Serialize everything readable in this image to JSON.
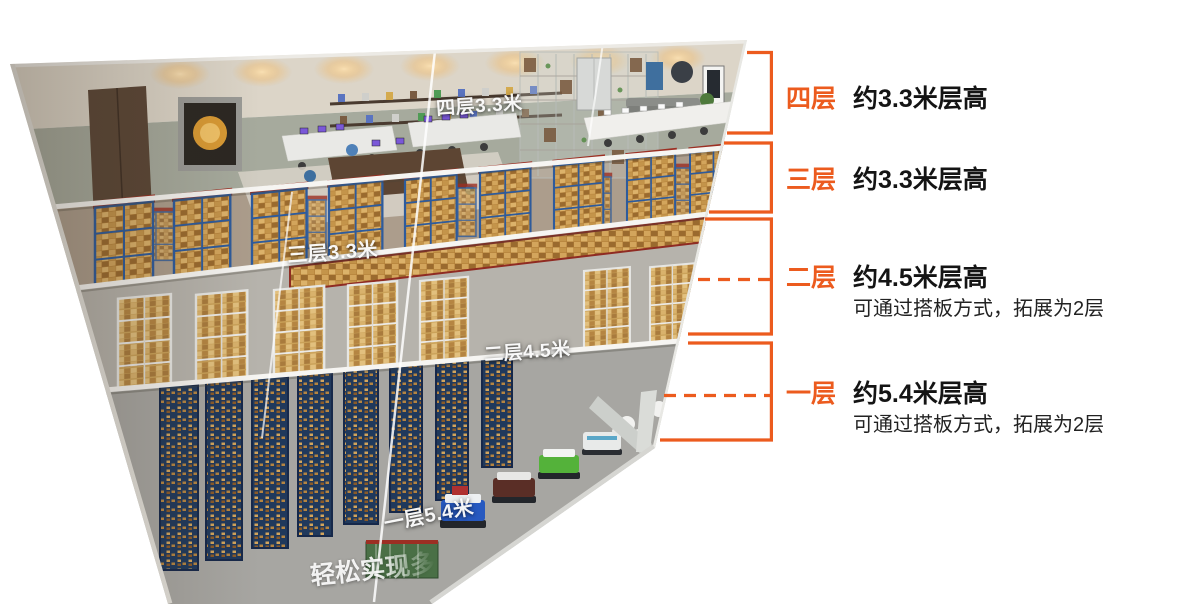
{
  "colors": {
    "accent_orange": "#EC5B1E",
    "text_dark": "#141414"
  },
  "annotations": [
    {
      "floor": "四层",
      "height_text": "约3.3米层高",
      "note": ""
    },
    {
      "floor": "三层",
      "height_text": "约3.3米层高",
      "note": ""
    },
    {
      "floor": "二层",
      "height_text": "约4.5米层高",
      "note": "可通过搭板方式，拓展为2层"
    },
    {
      "floor": "一层",
      "height_text": "约5.4米层高",
      "note": "可通过搭板方式，拓展为2层"
    }
  ],
  "building_labels": {
    "floor4_tag": "四层3.3米",
    "floor3_tag": "三层3.3米",
    "floor2_tag": "二层4.5米",
    "floor1_tag": "一层5.4米",
    "bottom_caption": "轻松实现多"
  }
}
